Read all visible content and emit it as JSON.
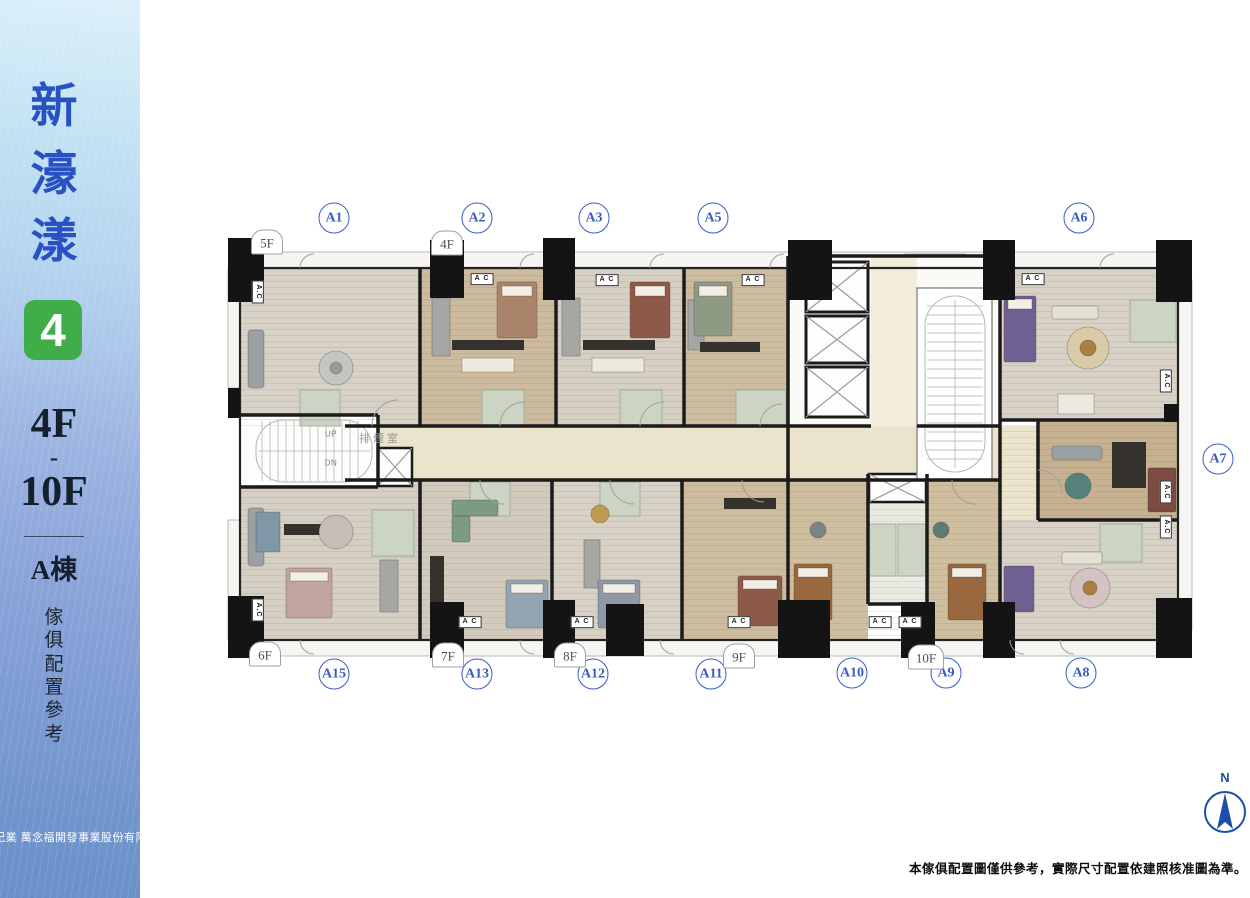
{
  "sidebar": {
    "title_chars": [
      "新",
      "濠",
      "漾"
    ],
    "logo_digit": "4",
    "floor_from": "4F",
    "floor_dash": "-",
    "floor_to": "10F",
    "building": "A棟",
    "note_chars": [
      "傢",
      "俱",
      "配",
      "置",
      "參",
      "考"
    ],
    "company": "紀業 萬念福開發事業股份有限公司",
    "colors": {
      "title_blue": "#2a51c4",
      "logo_green": "#3fae49",
      "dark_text": "#15202e"
    }
  },
  "plan": {
    "units": [
      {
        "label": "A1",
        "x": 334,
        "y": 218
      },
      {
        "label": "A2",
        "x": 477,
        "y": 218
      },
      {
        "label": "A3",
        "x": 594,
        "y": 218
      },
      {
        "label": "A5",
        "x": 713,
        "y": 218
      },
      {
        "label": "A6",
        "x": 1079,
        "y": 218
      },
      {
        "label": "A7",
        "x": 1218,
        "y": 459
      },
      {
        "label": "A15",
        "x": 334,
        "y": 674
      },
      {
        "label": "A13",
        "x": 477,
        "y": 674
      },
      {
        "label": "A12",
        "x": 593,
        "y": 674
      },
      {
        "label": "A11",
        "x": 711,
        "y": 674
      },
      {
        "label": "A10",
        "x": 852,
        "y": 673
      },
      {
        "label": "A9",
        "x": 946,
        "y": 673
      },
      {
        "label": "A8",
        "x": 1081,
        "y": 673
      }
    ],
    "floor_tags": [
      {
        "label": "5F",
        "x": 267,
        "y": 242
      },
      {
        "label": "4F",
        "x": 447,
        "y": 243
      },
      {
        "label": "6F",
        "x": 265,
        "y": 654
      },
      {
        "label": "7F",
        "x": 448,
        "y": 655
      },
      {
        "label": "8F",
        "x": 570,
        "y": 655
      },
      {
        "label": "9F",
        "x": 739,
        "y": 656
      },
      {
        "label": "10F",
        "x": 926,
        "y": 657
      }
    ],
    "ac_labels": [
      {
        "text": "A C",
        "x": 482,
        "y": 279,
        "vertical": false
      },
      {
        "text": "A C",
        "x": 607,
        "y": 280,
        "vertical": false
      },
      {
        "text": "A C",
        "x": 753,
        "y": 280,
        "vertical": false
      },
      {
        "text": "A C",
        "x": 1033,
        "y": 279,
        "vertical": false
      },
      {
        "text": "A C",
        "x": 470,
        "y": 622,
        "vertical": false
      },
      {
        "text": "A C",
        "x": 582,
        "y": 622,
        "vertical": false
      },
      {
        "text": "A C",
        "x": 739,
        "y": 622,
        "vertical": false
      },
      {
        "text": "A C",
        "x": 880,
        "y": 622,
        "vertical": false
      },
      {
        "text": "A C",
        "x": 910,
        "y": 622,
        "vertical": false
      },
      {
        "text": "A.C",
        "x": 258,
        "y": 292,
        "vertical": true
      },
      {
        "text": "A.C",
        "x": 258,
        "y": 610,
        "vertical": true
      },
      {
        "text": "A.C",
        "x": 1166,
        "y": 381,
        "vertical": true
      },
      {
        "text": "A.C",
        "x": 1166,
        "y": 492,
        "vertical": true
      },
      {
        "text": "A.C",
        "x": 1166,
        "y": 527,
        "vertical": true
      }
    ],
    "stair": {
      "up": "UP",
      "dn": "DN",
      "smoke_room": "排煙室"
    },
    "compass": {
      "label": "N",
      "color": "#1d4fa8"
    },
    "disclaimer": "本傢俱配置圖僅供參考，實際尺寸配置依建照核准圖為準。"
  }
}
